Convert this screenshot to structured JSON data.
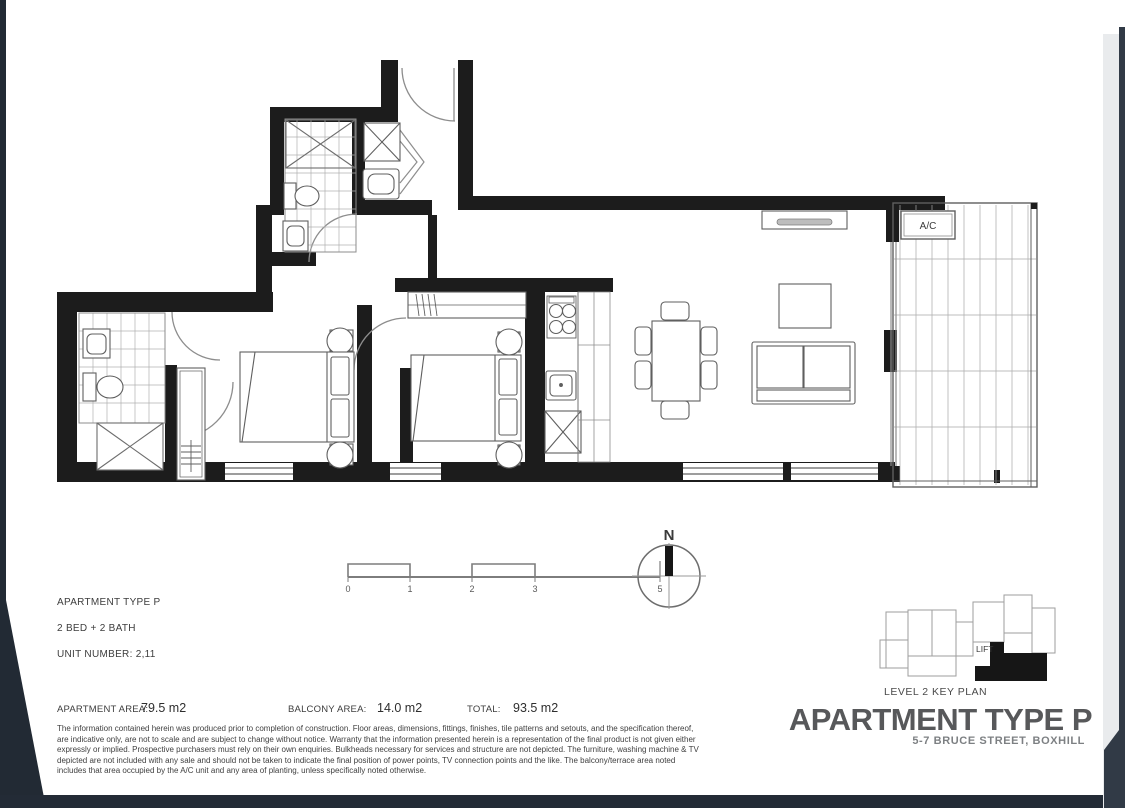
{
  "unit_info": {
    "type_label": "APARTMENT TYPE P",
    "beds_label": "2 BED + 2 BATH",
    "unit_number_label": "UNIT NUMBER: 2,11"
  },
  "areas": {
    "apartment_label": "APARTMENT AREA:",
    "apartment_value": "79.5 m2",
    "balcony_label": "BALCONY AREA:",
    "balcony_value": "14.0 m2",
    "total_label": "TOTAL:",
    "total_value": "93.5 m2"
  },
  "disclaimer": "The information contained herein was produced prior to completion of construction. Floor areas, dimensions, fittings, finishes, tile patterns and setouts, and the specification thereof, are indicative only, are not to scale and are subject to change without notice. Warranty that the information presented herein is a representation of the final product is not given either expressly or implied. Prospective purchasers must rely on their own enquiries. Bulkheads necessary for services and structure are not depicted. The furniture, washing machine & TV depicted are not included with any sale and should not be taken to indicate the final position of power points, TV connection points and the like. The balcony/terrace area noted includes that area occupied by the A/C unit and any area of planting, unless specifically noted otherwise.",
  "key_plan": {
    "lift_label": "LIFT",
    "caption": "LEVEL 2 KEY PLAN",
    "title": "APARTMENT TYPE P",
    "address": "5-7 BRUCE STREET, BOXHILL"
  },
  "plan": {
    "ac_label": "A/C",
    "north_label": "N"
  },
  "scale": {
    "t0": "0",
    "t1": "1",
    "t2": "2",
    "t3": "3",
    "t5": "5"
  },
  "colors": {
    "wall": "#1c1c1c",
    "furniture_line": "#5f5f5f",
    "tile_line": "#a8a8a8",
    "title_gray": "#57585a",
    "address_gray": "#7d8083",
    "page_edge": "#222a34"
  }
}
